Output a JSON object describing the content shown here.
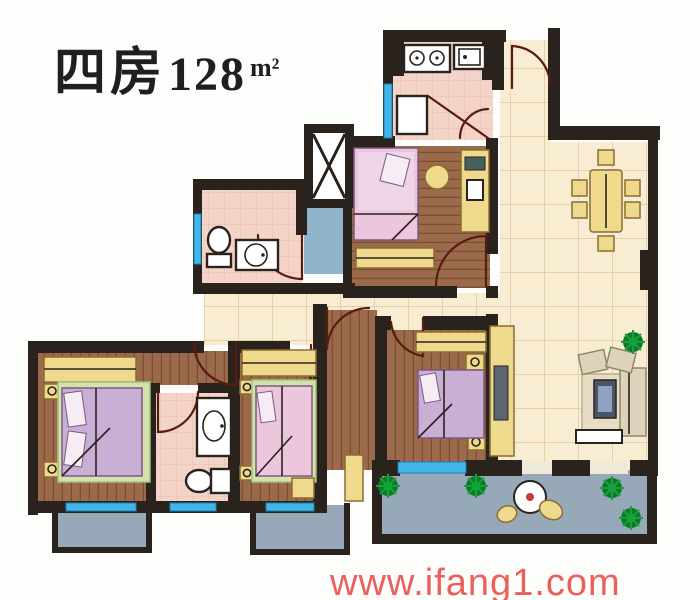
{
  "title": {
    "bedrooms": "四房",
    "area": "128",
    "unit": "m²"
  },
  "watermark": "www.ifang1.com",
  "floor_plan": {
    "label": "4-bedroom apartment floor plan, 128 square meters",
    "rooms": [
      "kitchen",
      "entry",
      "dining-area",
      "living-room",
      "bedroom-top",
      "bathroom-main",
      "bathroom-ensuite",
      "bedroom-left",
      "bedroom-middle",
      "bedroom-right",
      "hallway",
      "elevator",
      "shaft",
      "balcony-left",
      "balcony-middle",
      "balcony-right"
    ],
    "furniture_icons": [
      "stove-icon",
      "kitchen-sink-icon",
      "toilet-icon",
      "washbasin-icon",
      "bed-icon",
      "wardrobe-icon",
      "desk-icon",
      "computer-icon",
      "stool-icon",
      "dining-table-icon",
      "chair-icon",
      "sofa-icon",
      "armchair-icon",
      "coffee-table-icon",
      "tv-cabinet-icon",
      "plant-icon",
      "elevator-icon",
      "patio-table-icon",
      "nightstand-icon"
    ]
  },
  "colors": {
    "wall": "#2a231d",
    "tile": "#f8ecd2",
    "tileLine": "#d8bf92",
    "wood": "#9b6a4b",
    "woodLine": "#7a4e33",
    "pink": "#f4d4c8",
    "pinkLine": "#e7bcab",
    "window": "#41b7e9",
    "windowDark": "#1a7fb0",
    "balcony": "#97a9b8",
    "shaft": "#8fb4ca",
    "furn": "#eed98d",
    "furnLine": "#8a6d33",
    "bedA": "#c9aed6",
    "bedB": "#ecc6dc",
    "bedLine": "#7d5880",
    "rug": "#d2e4ab",
    "white": "#ffffff",
    "plant": "#17a13b",
    "plantDark": "#0c7a28",
    "door": "#5a1b10",
    "sofa": "#dcd3ba",
    "sofaLine": "#8f8668",
    "coffee": "#4a5668",
    "watermark": "#e9544e",
    "ink": "#1f1f1f"
  }
}
